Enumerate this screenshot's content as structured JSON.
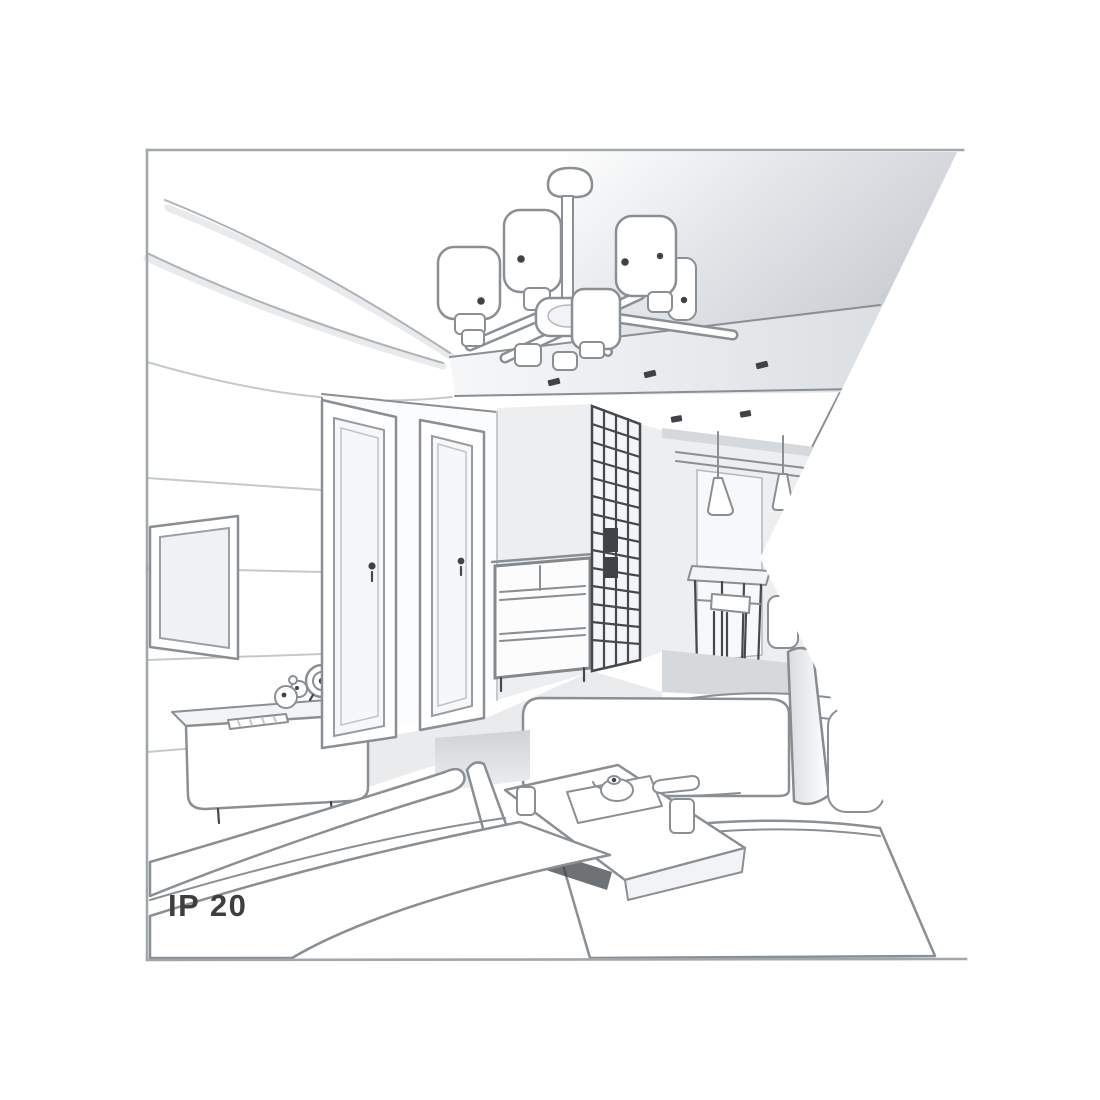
{
  "label": {
    "text": "IP 20"
  },
  "colors": {
    "bg": "#ffffff",
    "frame": "#a2a7ab",
    "line": "#8a8f93",
    "line_faint": "#c5c9cc",
    "line_dark": "#45494d",
    "ink": "#3f4347",
    "shade_pale": "#f2f3f5",
    "shade_light": "#eceef0",
    "shade_mid": "#d6d9dc",
    "ceiling_deep": "#c9cdd1",
    "text": "#3e3e3e"
  },
  "scene": {
    "kind": "grayscale perspective sketch of a living room interior",
    "objects": [
      "ceiling-chandelier with cylindrical shades",
      "tray ceiling with recessed spotlights",
      "panelled tv wall with flat screen",
      "tv sideboard with clock and figurine",
      "two interior doors",
      "chest of drawers",
      "lattice-front wardrobe",
      "hallway with cone pendant lamps and dining table",
      "sofas and coffee table with tea set",
      "ip-rating label"
    ]
  }
}
